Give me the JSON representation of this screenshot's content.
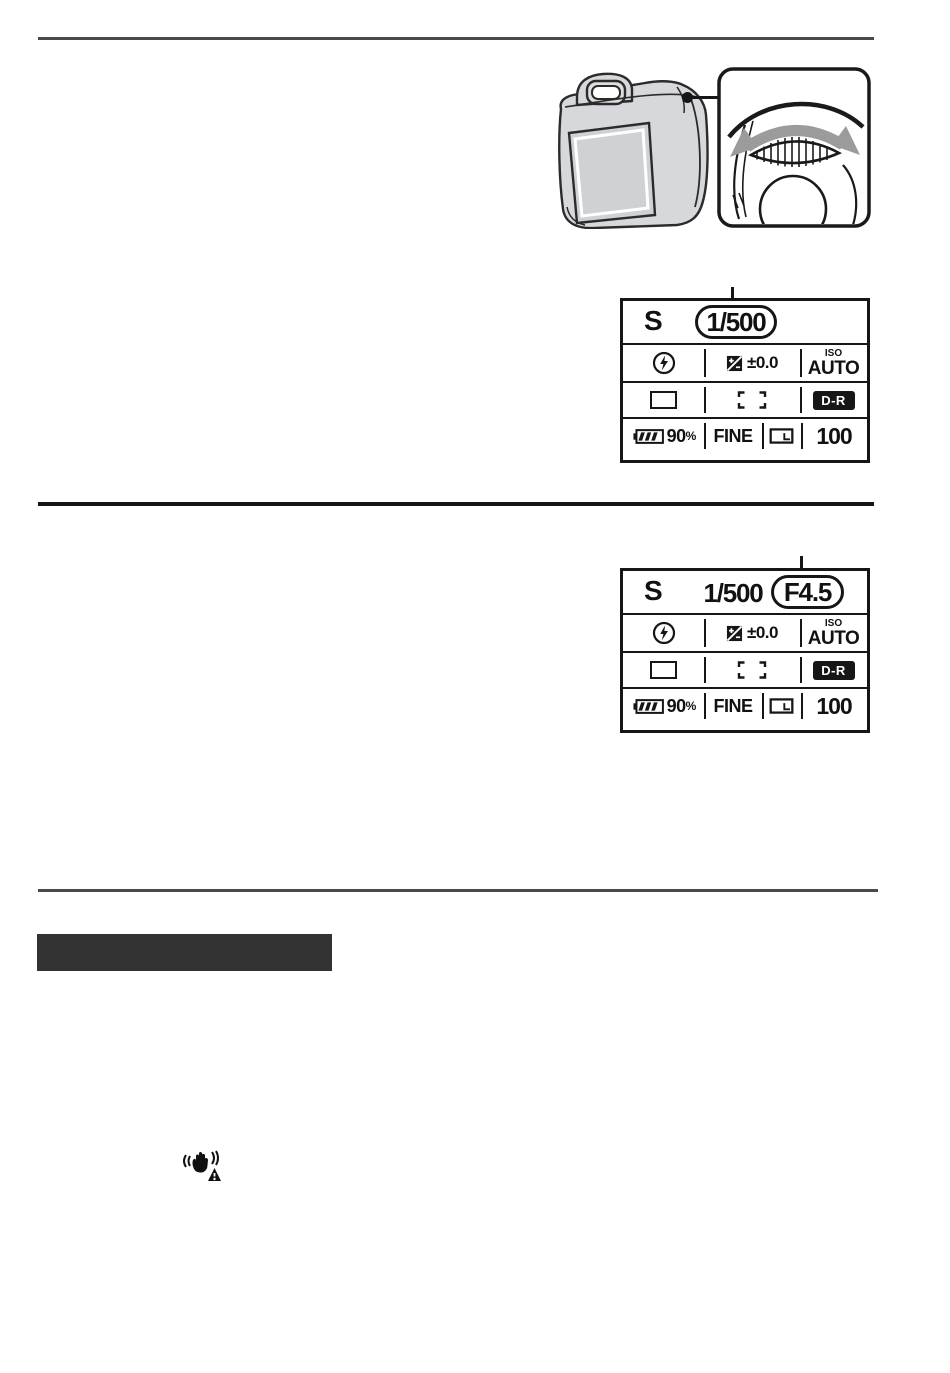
{
  "page": {
    "kind": "camera-manual-scanned-page",
    "background": "#ffffff"
  },
  "colors": {
    "section_bar": "#333333",
    "rule_gray": "#4a4a4a",
    "rule_dark": "#141414",
    "lcd_ink": "#161616",
    "camera_fill": "#d6d8db",
    "arrow_gray": "#9b9b9b"
  },
  "figure": {
    "camera_icon": "dslr-rear-view-illustration",
    "callout_icon": "control-dial-with-rotation-arrows",
    "leader": "dot-and-line-from-dial-to-callout"
  },
  "panels": [
    {
      "mode": "S",
      "shutter": "1/500",
      "aperture": "",
      "highlight": "shutter",
      "flash_icon": "flash-auto-icon",
      "ev_icon": "exposure-compensation-icon",
      "ev_value": "±0.0",
      "iso_label": "ISO",
      "iso_value": "AUTO",
      "drive_icon": "single-shooting-icon",
      "focus_icon": "focus-area-brackets-icon",
      "dr_label": "D-R",
      "battery_icon": "battery-level-icon",
      "battery_value": "90",
      "battery_unit": "%",
      "quality": "FINE",
      "size_icon": "image-size-icon",
      "shots": "100"
    },
    {
      "mode": "S",
      "shutter": "1/500",
      "aperture": "F4.5",
      "highlight": "aperture",
      "flash_icon": "flash-auto-icon",
      "ev_icon": "exposure-compensation-icon",
      "ev_value": "±0.0",
      "iso_label": "ISO",
      "iso_value": "AUTO",
      "drive_icon": "single-shooting-icon",
      "focus_icon": "focus-area-brackets-icon",
      "dr_label": "D-R",
      "battery_icon": "battery-level-icon",
      "battery_value": "90",
      "battery_unit": "%",
      "quality": "FINE",
      "size_icon": "image-size-icon",
      "shots": "100"
    }
  ],
  "section_bar": {
    "label": ""
  },
  "warnings": {
    "shake_icon": "camera-shake-warning-icon"
  }
}
